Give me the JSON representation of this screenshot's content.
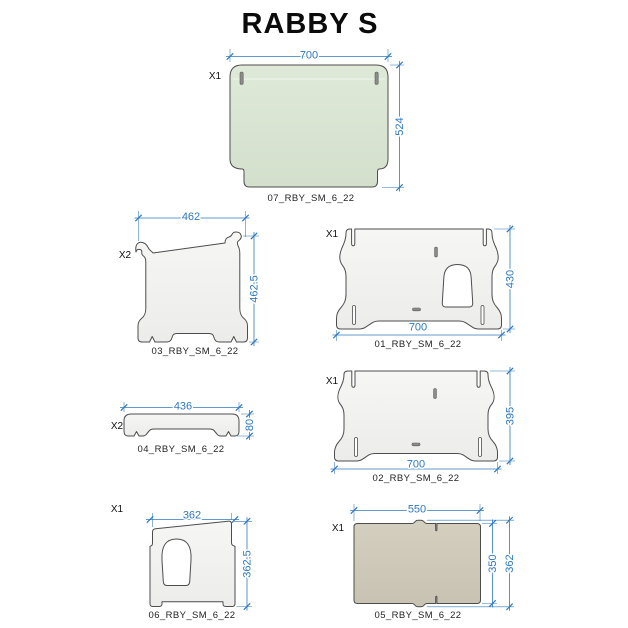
{
  "title": "RABBY S",
  "colors": {
    "dim": "#2e78be",
    "outline": "#4d4d4d",
    "slot-fill": "#8c8c8c",
    "fill-gray-top": "#f6f6f5",
    "fill-gray-bottom": "#ececea",
    "fill-green-top": "#dfe9d8",
    "fill-green-bottom": "#d3e0cc",
    "fill-tan-top": "#d4cfbf",
    "fill-tan-bottom": "#c7c2b1",
    "bg": "#ffffff"
  },
  "parts": {
    "p07": {
      "id": "07_RBY_SM_6_22",
      "qty": "X1",
      "dim_w": "700",
      "dim_h": "524"
    },
    "p03": {
      "id": "03_RBY_SM_6_22",
      "qty": "X2",
      "dim_w": "462",
      "dim_h": "462.5"
    },
    "p01": {
      "id": "01_RBY_SM_6_22",
      "qty": "X1",
      "dim_w": "700",
      "dim_h": "430"
    },
    "p02": {
      "id": "02_RBY_SM_6_22",
      "qty": "X1",
      "dim_w": "700",
      "dim_h": "395"
    },
    "p04": {
      "id": "04_RBY_SM_6_22",
      "qty": "X2",
      "dim_w": "436",
      "dim_h": "80"
    },
    "p06": {
      "id": "06_RBY_SM_6_22",
      "qty": "X1",
      "dim_w": "362",
      "dim_h": "362.5"
    },
    "p05": {
      "id": "05_RBY_SM_6_22",
      "qty": "X1",
      "dim_w": "550",
      "dim_h_inner": "350",
      "dim_h_outer": "362"
    }
  }
}
